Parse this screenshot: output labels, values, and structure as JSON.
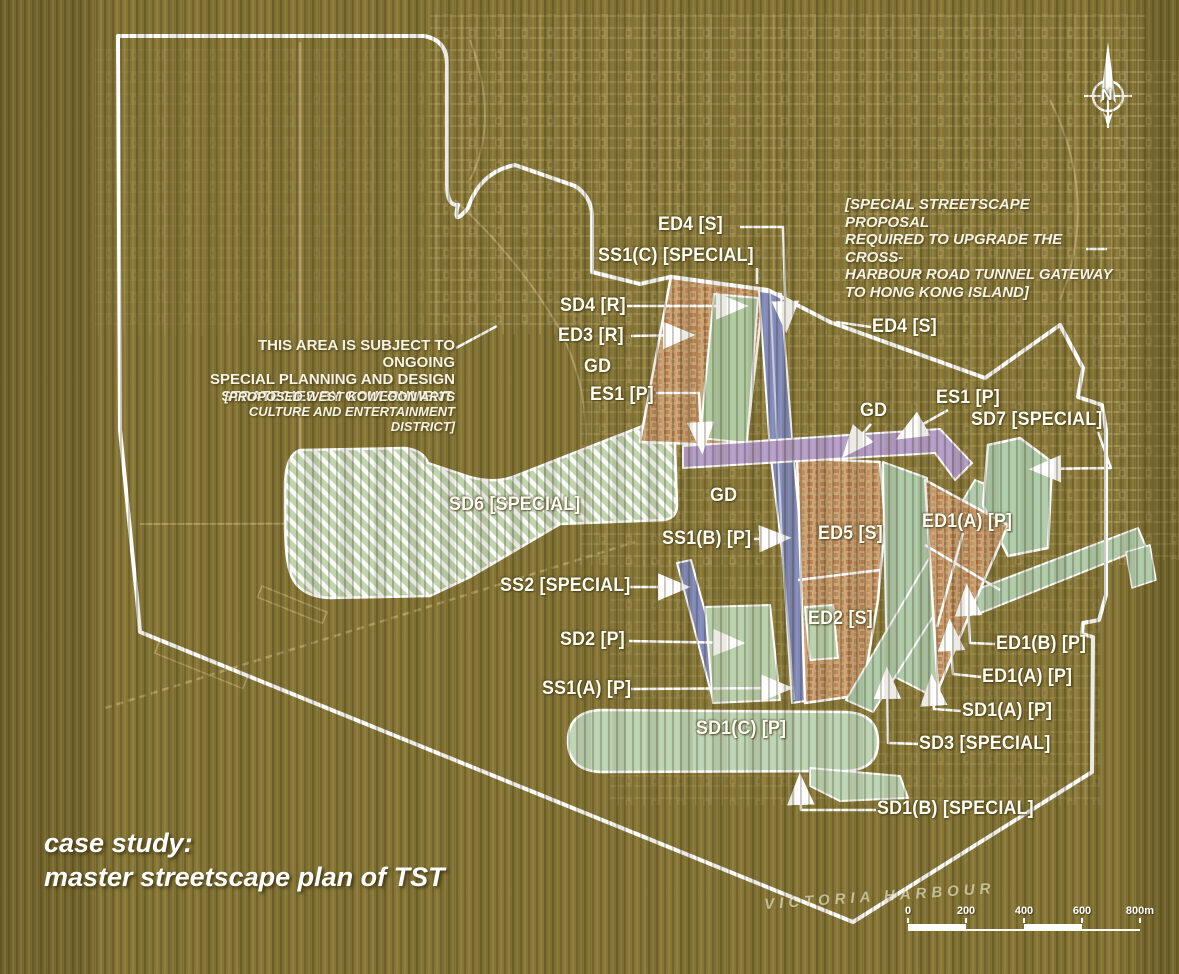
{
  "caption": {
    "line1": "case study:",
    "line2": "master streetscape plan of TST"
  },
  "notes": {
    "west_kowloon": {
      "main": "THIS AREA IS SUBJECT TO ONGOING\nSPECIAL PLANNING AND DESIGN\nSTRATEGIES BY GOVERNMENT.",
      "sub": "[PROPOSED WEST KOWLOON ARTS\nCULTURE AND ENTERTAINMENT DISTRICT]"
    },
    "cross_harbour": {
      "text": "[SPECIAL STREETSCAPE PROPOSAL\nREQUIRED TO UPGRADE THE CROSS-\nHARBOUR ROAD TUNNEL GATEWAY\nTO HONG KONG ISLAND]"
    }
  },
  "map_text": {
    "harbour": "VICTORIA HARBOUR"
  },
  "compass": {
    "label": "N"
  },
  "scale_bar": {
    "ticks": [
      "0",
      "200",
      "400",
      "600",
      "800m"
    ]
  },
  "colors": {
    "background": "#857535",
    "zone_green": "#bfd3ae",
    "zone_orange": "#c9a273",
    "road_blue": "#8089ba",
    "road_purple": "#b49cc8",
    "line_white": "#ffffff"
  },
  "zone_labels": [
    {
      "text": "ED4 [S]",
      "x": 658,
      "y": 214
    },
    {
      "text": "SS1(C) [SPECIAL]",
      "x": 598,
      "y": 245
    },
    {
      "text": "SD4 [R]",
      "x": 560,
      "y": 295
    },
    {
      "text": "ED3 [R]",
      "x": 558,
      "y": 325
    },
    {
      "text": "GD",
      "x": 584,
      "y": 356
    },
    {
      "text": "ES1 [P]",
      "x": 590,
      "y": 384
    },
    {
      "text": "ED4 [S]",
      "x": 872,
      "y": 316
    },
    {
      "text": "GD",
      "x": 860,
      "y": 400
    },
    {
      "text": "ES1 [P]",
      "x": 936,
      "y": 387
    },
    {
      "text": "SD7 [SPECIAL]",
      "x": 971,
      "y": 409
    },
    {
      "text": "SD6 [SPECIAL]",
      "x": 449,
      "y": 494
    },
    {
      "text": "GD",
      "x": 710,
      "y": 485
    },
    {
      "text": "SS1(B)  [P]",
      "x": 662,
      "y": 528
    },
    {
      "text": "ED5 [S]",
      "x": 818,
      "y": 523
    },
    {
      "text": "ED1(A) [P]",
      "x": 922,
      "y": 511
    },
    {
      "text": "SS2 [SPECIAL]",
      "x": 500,
      "y": 575
    },
    {
      "text": "ED2 [S]",
      "x": 808,
      "y": 608
    },
    {
      "text": "SD2 [P]",
      "x": 560,
      "y": 629
    },
    {
      "text": "SS1(A) [P]",
      "x": 542,
      "y": 678
    },
    {
      "text": "SD1(C) [P]",
      "x": 696,
      "y": 718
    },
    {
      "text": "ED1(B) [P]",
      "x": 996,
      "y": 633
    },
    {
      "text": "ED1(A) [P]",
      "x": 982,
      "y": 666
    },
    {
      "text": "SD1(A) [P]",
      "x": 962,
      "y": 700
    },
    {
      "text": "SD3  [SPECIAL]",
      "x": 919,
      "y": 733
    },
    {
      "text": "SD1(B) [SPECIAL]",
      "x": 877,
      "y": 798
    }
  ],
  "leaders": [
    {
      "points": [
        [
          740,
          227
        ],
        [
          783,
          227
        ],
        [
          786,
          326
        ]
      ],
      "arrow": true
    },
    {
      "points": [
        [
          757,
          268
        ],
        [
          757,
          284
        ]
      ],
      "arrow": false
    },
    {
      "points": [
        [
          627,
          306
        ],
        [
          741,
          306
        ]
      ],
      "arrow": true
    },
    {
      "points": [
        [
          631,
          336
        ],
        [
          688,
          335
        ]
      ],
      "arrow": true
    },
    {
      "points": [
        [
          656,
          393
        ],
        [
          699,
          393
        ],
        [
          702,
          447
        ]
      ],
      "arrow": true
    },
    {
      "points": [
        [
          871,
          327
        ],
        [
          836,
          322
        ]
      ],
      "arrow": false
    },
    {
      "points": [
        [
          871,
          424
        ],
        [
          847,
          452
        ]
      ],
      "arrow": true
    },
    {
      "points": [
        [
          948,
          410
        ],
        [
          902,
          436
        ]
      ],
      "arrow": true
    },
    {
      "points": [
        [
          1098,
          432
        ],
        [
          1111,
          468
        ],
        [
          1036,
          469
        ]
      ],
      "arrow": true
    },
    {
      "points": [
        [
          754,
          539
        ],
        [
          784,
          538
        ]
      ],
      "arrow": true
    },
    {
      "points": [
        [
          629,
          587
        ],
        [
          683,
          587
        ]
      ],
      "arrow": true
    },
    {
      "points": [
        [
          629,
          641
        ],
        [
          738,
          643
        ]
      ],
      "arrow": true
    },
    {
      "points": [
        [
          631,
          689
        ],
        [
          786,
          688
        ]
      ],
      "arrow": true
    },
    {
      "points": [
        [
          995,
          644
        ],
        [
          970,
          643
        ],
        [
          967,
          591
        ]
      ],
      "arrow": true
    },
    {
      "points": [
        [
          981,
          677
        ],
        [
          953,
          674
        ],
        [
          950,
          626
        ]
      ],
      "arrow": true
    },
    {
      "points": [
        [
          961,
          711
        ],
        [
          934,
          709
        ],
        [
          932,
          681
        ]
      ],
      "arrow": true
    },
    {
      "points": [
        [
          918,
          744
        ],
        [
          888,
          743
        ],
        [
          887,
          674
        ]
      ],
      "arrow": true
    },
    {
      "points": [
        [
          876,
          810
        ],
        [
          801,
          810
        ],
        [
          800,
          780
        ]
      ],
      "arrow": true
    },
    {
      "points": [
        [
          456,
          348
        ],
        [
          497,
          326
        ]
      ],
      "arrow": false
    },
    {
      "points": [
        [
          1086,
          249
        ],
        [
          1107,
          249
        ]
      ],
      "arrow": false
    }
  ]
}
